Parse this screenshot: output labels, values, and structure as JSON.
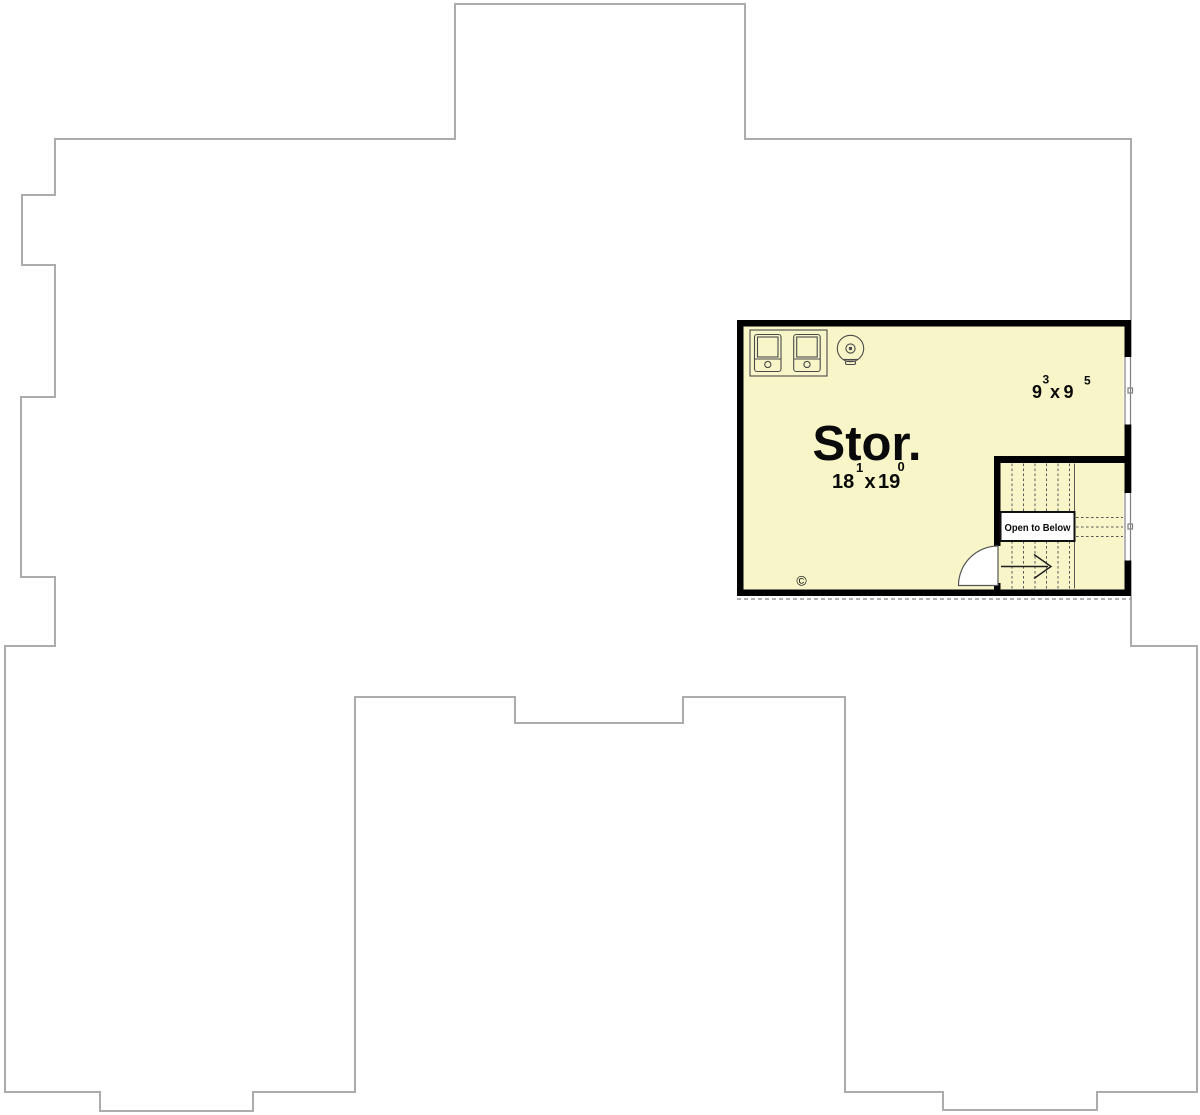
{
  "room": {
    "name": "Stor."
  },
  "room_dim": {
    "a": "18",
    "a_sup": "1",
    "sep": "x",
    "b": "19",
    "b_sup": "0"
  },
  "alcove_dim": {
    "a": "9",
    "a_sup": "3",
    "sep": "x",
    "b": "9",
    "b_sup": "5"
  },
  "stairs": {
    "open_to_below": "Open to Below",
    "down": "DN"
  },
  "symbols": {
    "copyright": "©"
  },
  "colors": {
    "floor_fill": "#F8F6C9",
    "wall": "#000000",
    "outline": "#ACACAC",
    "tread_line": "#5A5A5A"
  }
}
